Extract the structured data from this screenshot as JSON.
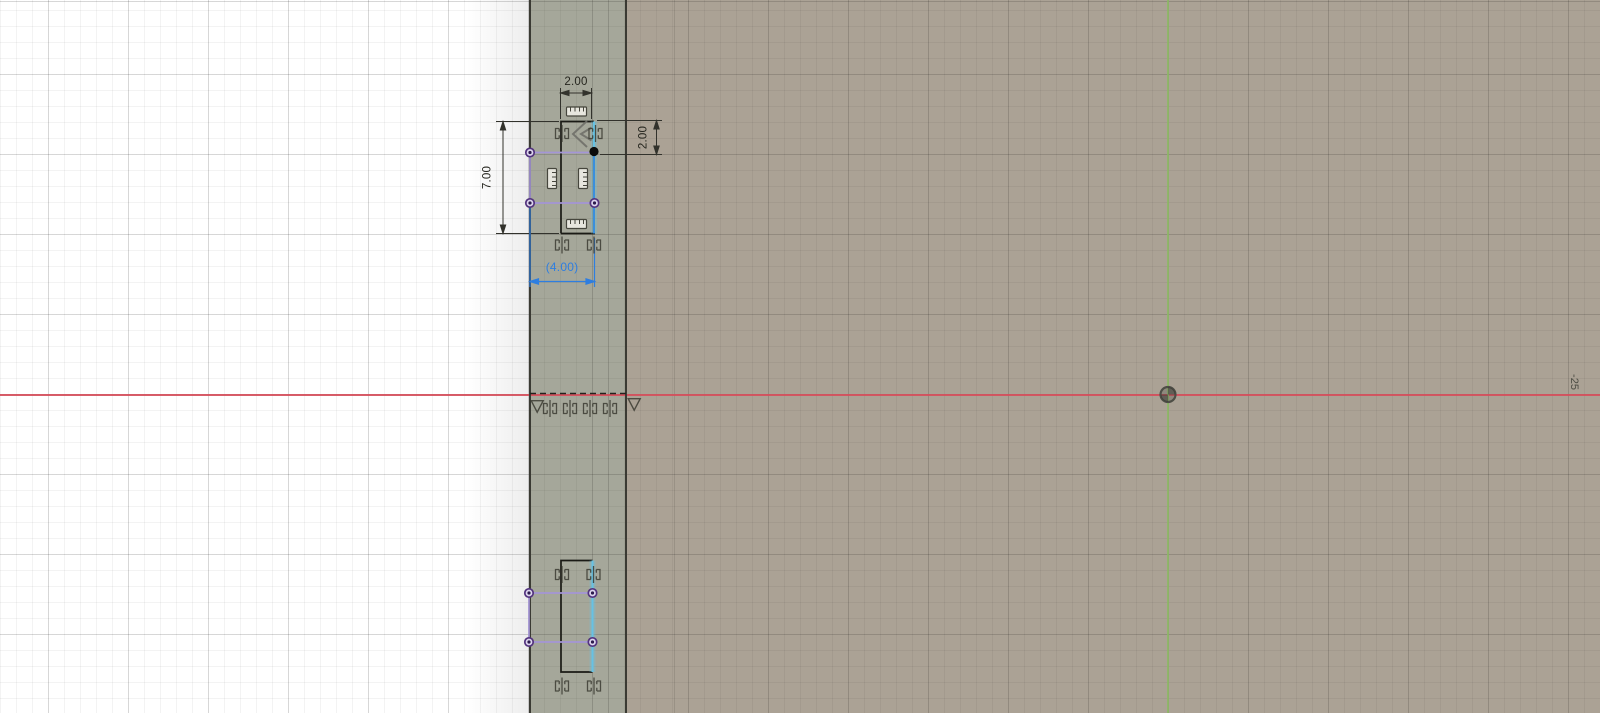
{
  "app": {
    "title": "CAD sketch canvas view"
  },
  "labels": {
    "dim_top_width": "2.00",
    "dim_right_height": "2.00",
    "dim_left_height": "7.00",
    "dim_bottom_width_driven": "(4.00)",
    "grid_coordinate": "-25"
  },
  "colors": {
    "canvas_white": "#ffffff",
    "face_strip": "#a5a79a",
    "face_body": "#aba295",
    "x_axis_red": "#d54f5c",
    "y_axis_green": "#8cb964",
    "selected_blue": "#2e7ee0",
    "highlight_cyan": "#66c2e4",
    "projected_purple": "#a495d6",
    "dimension_black": "#26261f",
    "constraint_gray": "#3c3c33"
  },
  "icons": [
    "origin-icon",
    "midpoint-constraint-icon",
    "symmetry-constraint-icon",
    "collinear-constraint-icon",
    "perpendicular-constraint-icon",
    "sketch-point",
    "selected-point"
  ]
}
